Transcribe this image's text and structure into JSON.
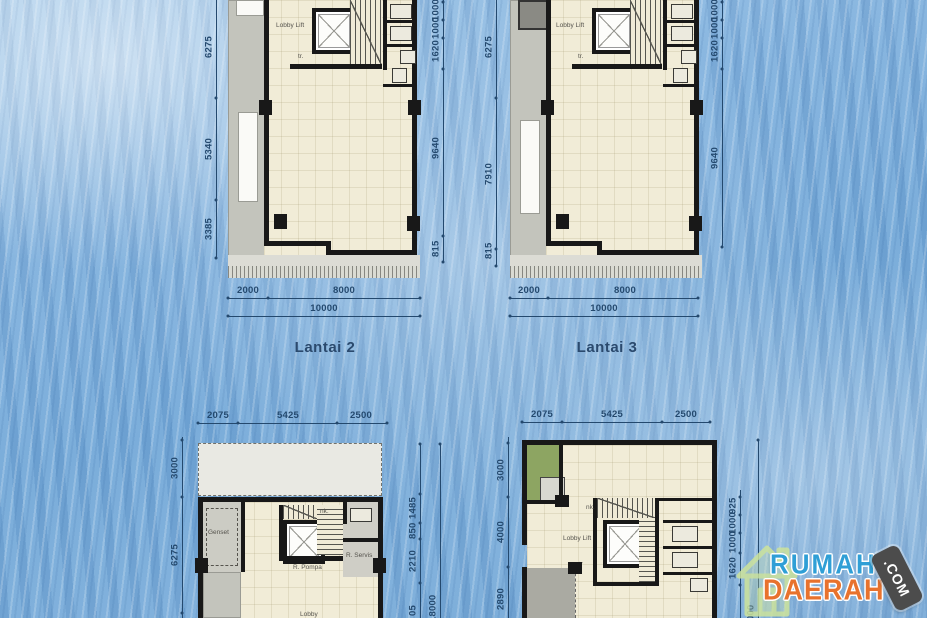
{
  "floor_plans": {
    "lantai2": {
      "title": "Lantai 2",
      "room_labels": {
        "lobby_lift": "Lobby Lift",
        "tr": "tr."
      },
      "dims": {
        "left": [
          "6275",
          "5340",
          "3385"
        ],
        "right_chain": [
          "1000",
          "1000",
          "1620"
        ],
        "right_main": "9640",
        "right_bottom": "815",
        "bottom": [
          "2000",
          "8000"
        ],
        "bottom_total": "10000"
      }
    },
    "lantai3": {
      "title": "Lantai 3",
      "room_labels": {
        "lobby_lift": "Lobby Lift",
        "tr": "tr."
      },
      "dims": {
        "left": [
          "6275",
          "7910",
          "815"
        ],
        "right_chain": [
          "1000",
          "1000",
          "1620"
        ],
        "right_main": "9640",
        "bottom": [
          "2000",
          "8000"
        ],
        "bottom_total": "10000"
      }
    },
    "ground_left": {
      "room_labels": {
        "genset": "Genset",
        "r_pompa": "R. Pompa",
        "r_servis": "R. Servis",
        "lobby": "Lobby",
        "nk": "nk."
      },
      "dims": {
        "top": [
          "2075",
          "5425",
          "2500"
        ],
        "left": [
          "3000",
          "6275"
        ],
        "right_chain": [
          "1485",
          "850",
          "2210",
          "05"
        ],
        "right_total": "18000"
      }
    },
    "ground_right": {
      "room_labels": {
        "lobby_lift": "Lobby Lift",
        "nk": "nk.",
        "tr": "tr"
      },
      "dims": {
        "top": [
          "2075",
          "5425",
          "2500"
        ],
        "left": [
          "3000",
          "4000",
          "2890"
        ],
        "right_chain": [
          "925",
          "1000",
          "1000",
          "1620"
        ],
        "right_total": "18000"
      }
    }
  },
  "logo": {
    "word1": "RUMAH",
    "word2": "DAERAH",
    "badge": ".COM"
  },
  "colors": {
    "background_blue": "#79abd8",
    "floor_cream": "#f1ecd7",
    "wall_black": "#181818",
    "dim_navy": "#24496e",
    "logo_blue": "#2f9fd6",
    "logo_orange": "#e8722d",
    "accent_green": "#8da562"
  }
}
